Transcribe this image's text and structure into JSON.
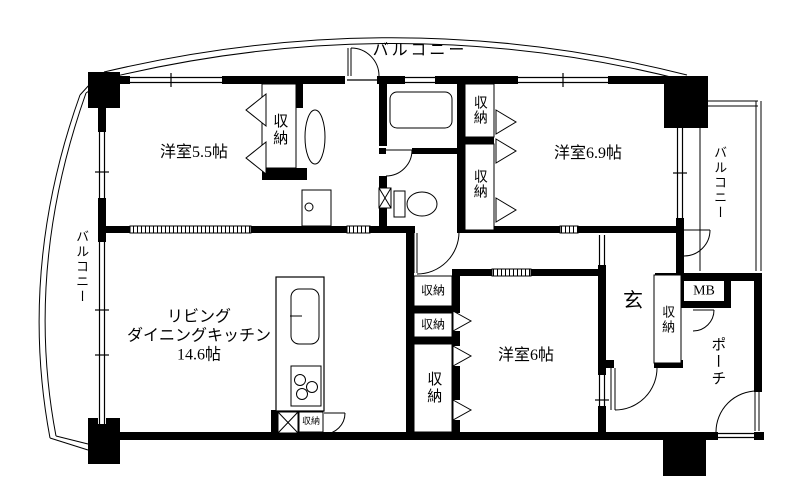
{
  "document": {
    "type": "apartment-floor-plan"
  },
  "colors": {
    "wall": "#000000",
    "line": "#000000",
    "background": "#ffffff"
  },
  "labels": {
    "balcony_top": "バルコニー",
    "balcony_left": "バルコニー",
    "balcony_right": "バルコニー",
    "porch": "ポーチ",
    "room_55": "洋室5.5帖",
    "room_69": "洋室6.9帖",
    "room_6": "洋室6帖",
    "ldk_line1": "リビング",
    "ldk_line2": "ダイニングキッチン",
    "ldk_line3": "14.6帖",
    "entrance": "玄",
    "meter_box": "MB",
    "closet_55": "収納",
    "closet_69_upper": "収納",
    "closet_69_lower": "収納",
    "closet_mid_a": "収納",
    "closet_mid_b": "収納",
    "closet_mid_c": "収納",
    "closet_kitchen": "収納",
    "closet_entrance": "収納"
  }
}
